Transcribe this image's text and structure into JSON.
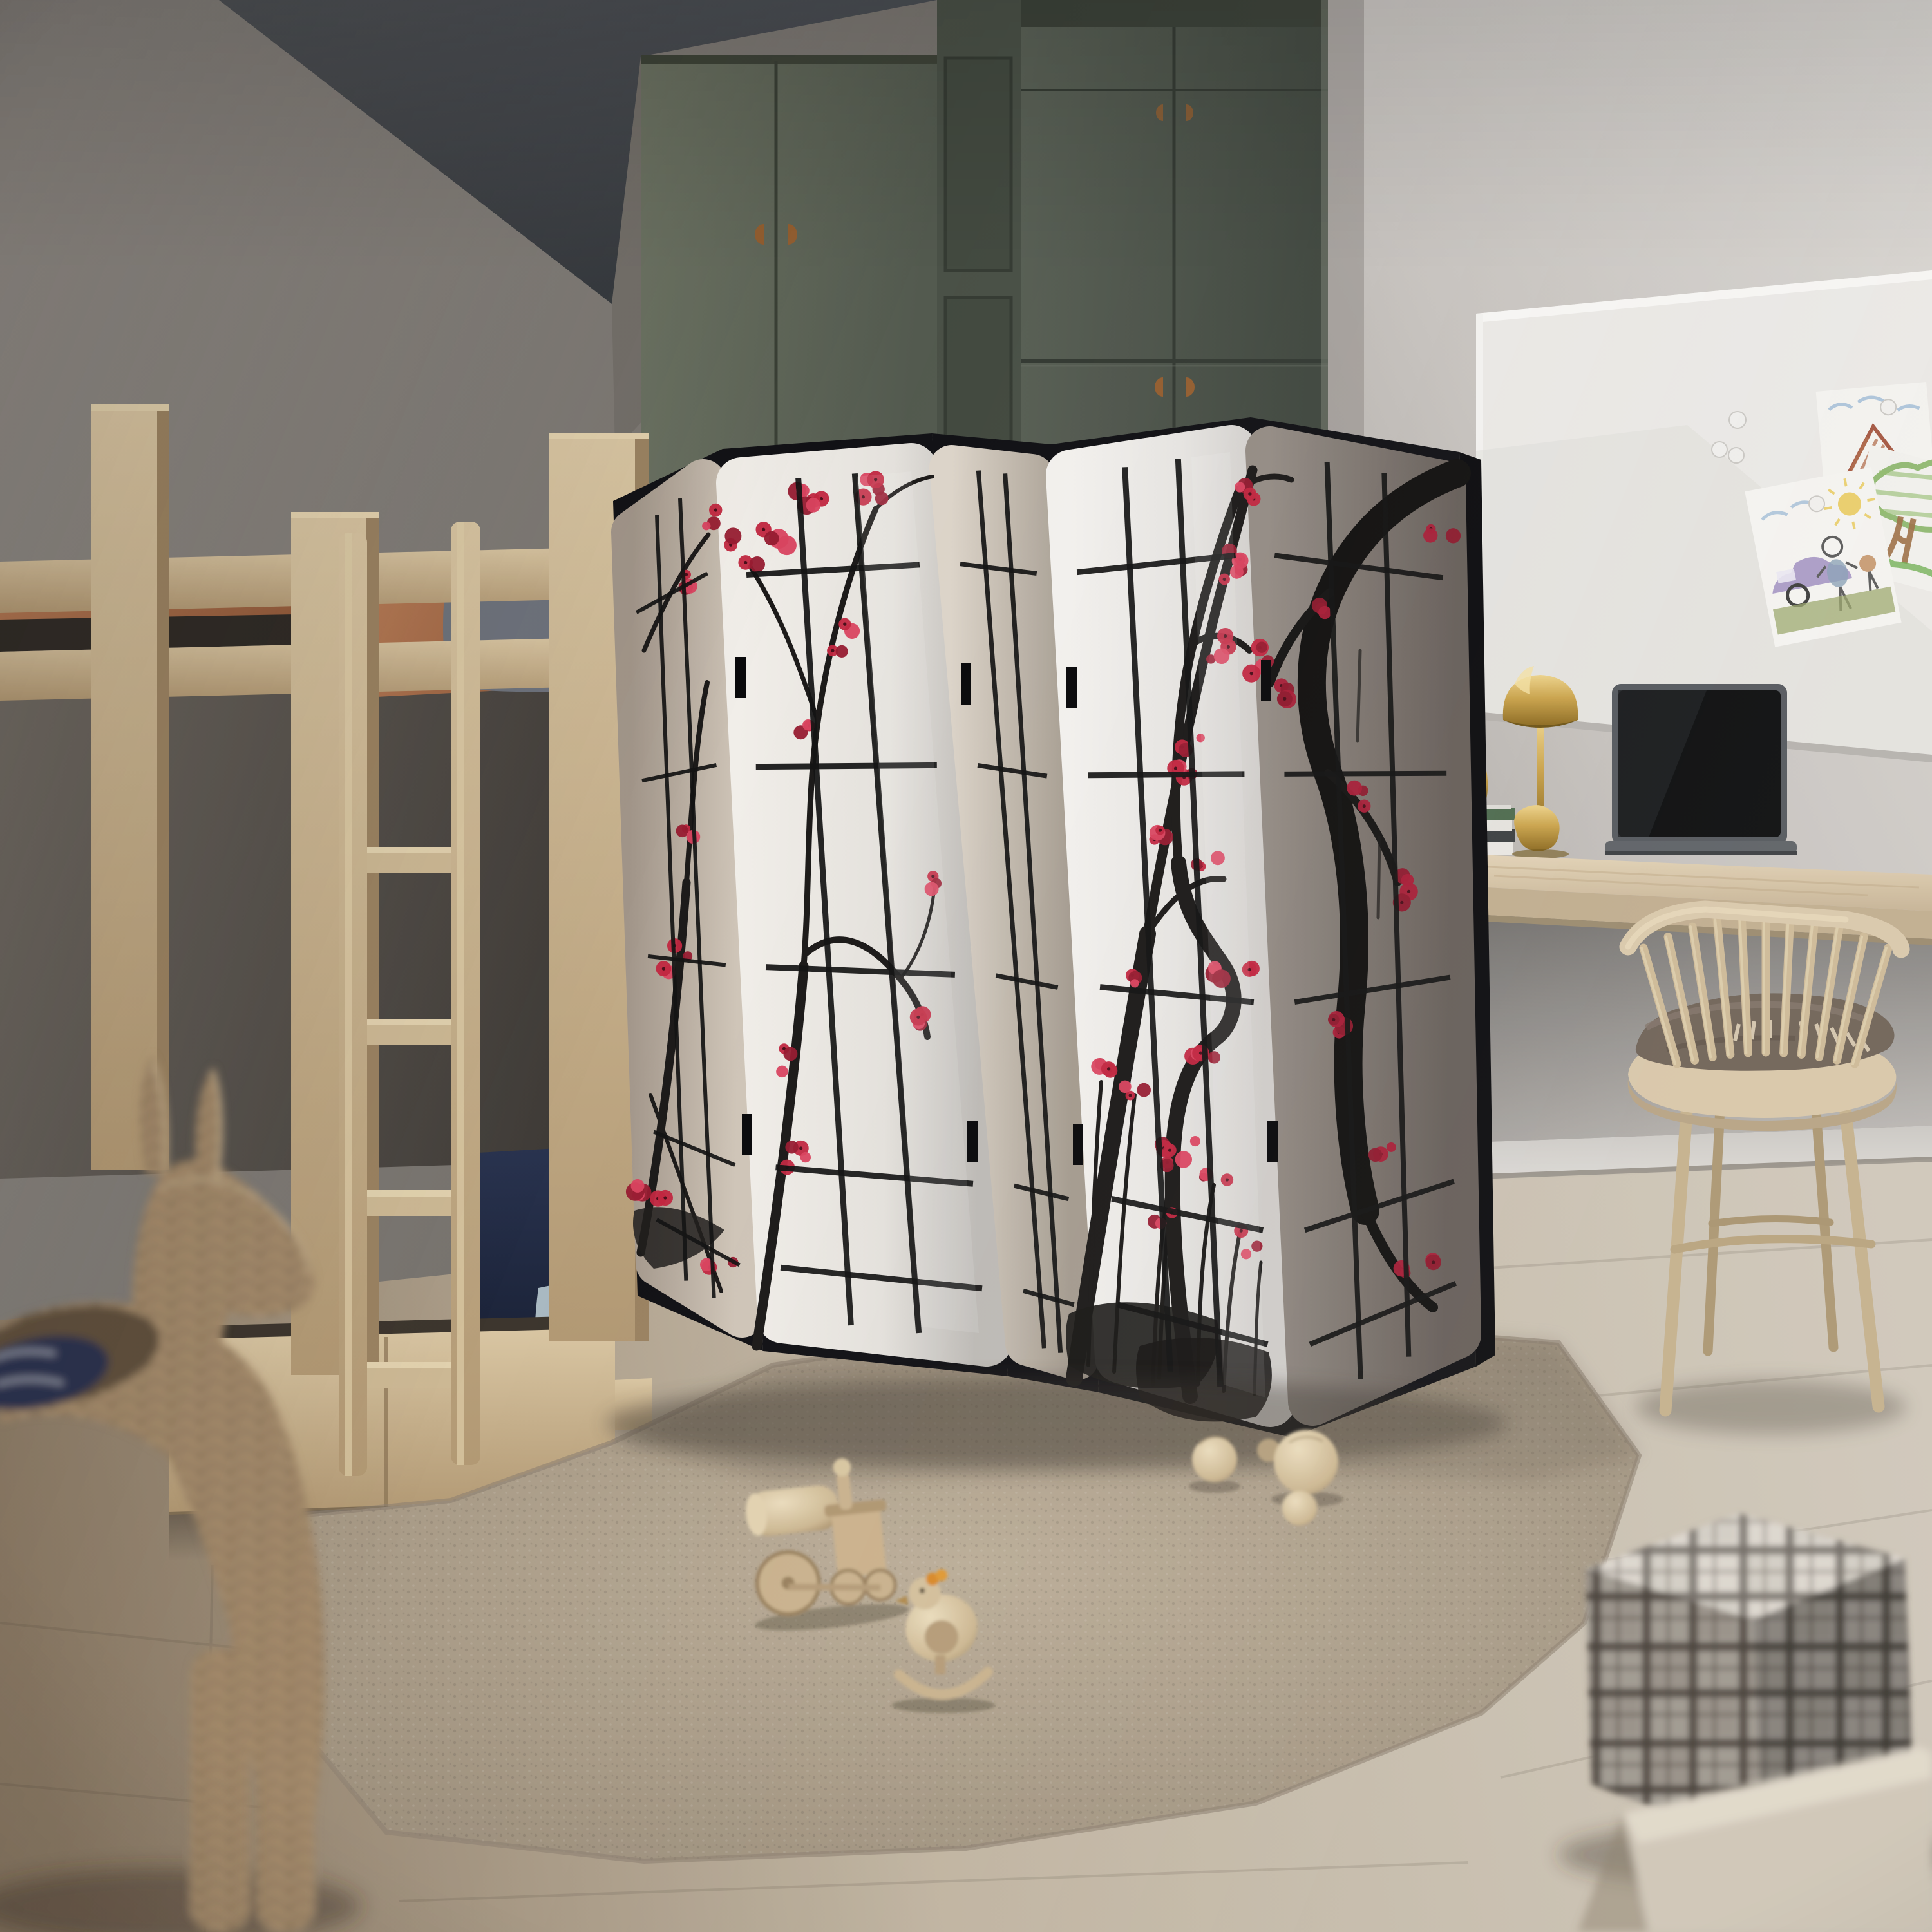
{
  "scene": {
    "description": "Photorealistic render of a children's bedroom with a five-panel black shoji folding screen painted with cherry-plum blossoms, a wooden bunk bed, a sage-green wardrobe, a wall desk with gold lamp and laptop, a spindle chair, a shag rug with wooden toys, a wicker animal basket and plaid storage boxes.",
    "objects": [
      {
        "id": "bunk-bed",
        "label": "wooden bunk bed with ladder"
      },
      {
        "id": "wardrobe",
        "label": "sage green wardrobe"
      },
      {
        "id": "room-divider-screen",
        "label": "5-panel black shoji folding screen with plum blossom ink painting"
      },
      {
        "id": "whiteboard",
        "label": "magnetic whiteboard"
      },
      {
        "id": "drawing-house",
        "label": "child's drawing of a house"
      },
      {
        "id": "drawing-car-figure",
        "label": "child's drawing of car, person and sun"
      },
      {
        "id": "drawing-tree",
        "label": "child's drawing of a tree"
      },
      {
        "id": "magnets",
        "label": "round whiteboard magnets"
      },
      {
        "id": "desk",
        "label": "wall-mounted wooden desk"
      },
      {
        "id": "table-lamp",
        "label": "gold mushroom table lamp"
      },
      {
        "id": "sculpture",
        "label": "small gold sculpture"
      },
      {
        "id": "book-stack",
        "label": "stack of books and magazines"
      },
      {
        "id": "laptop",
        "label": "open laptop with dark screen"
      },
      {
        "id": "chair",
        "label": "light wood spindle chair"
      },
      {
        "id": "throw-blanket",
        "label": "folded taupe blanket with fringe"
      },
      {
        "id": "rug",
        "label": "beige shag rug"
      },
      {
        "id": "wooden-train",
        "label": "wooden toy locomotive"
      },
      {
        "id": "wooden-rocking-bird",
        "label": "wooden rocking bird toy"
      },
      {
        "id": "wooden-balls",
        "label": "four wooden balls"
      },
      {
        "id": "wicker-animal-basket",
        "label": "wicker donkey-shaped basket"
      },
      {
        "id": "plaid-storage-box",
        "label": "plaid fabric storage box"
      },
      {
        "id": "fabric-storage-box",
        "label": "beige fabric storage box"
      }
    ]
  },
  "palette": {
    "ceiling": "#43474d",
    "wall-left": "#8f8b87",
    "wall-left-dark": "#55514c",
    "wall-right": "#dad7d3",
    "wall-right-shade": "#aba7a3",
    "floor-left": "#8c7b66",
    "floor-mid": "#c0b4a1",
    "floor-right": "#cfc7ba",
    "baseboard": "#dcd9d5",
    "wardrobe-far": "#68705f",
    "wardrobe-near": "#515849",
    "wardrobe-dark": "#3c4239",
    "handle-wood": "#945f31",
    "bed-wood": "#cdb893",
    "bed-wood-dark": "#a18868",
    "duvet-top": "#aa684a",
    "pillow-gray": "#6e737d",
    "navy": "#1f2940",
    "pillow-blue": "#a9b9c2",
    "duvet-olive": "#81795e",
    "rug": "#b2a48f",
    "rug-dark": "#968977",
    "screen-frame": "#121216",
    "paper1": "#b4a799",
    "paper2": "#ece9e5",
    "paper3": "#d5cdc2",
    "paper4": "#f0eeeb",
    "paper5": "#8d857f",
    "ink": "#1d1b1a",
    "blossom": "#c12740",
    "blossom-dark": "#971c31",
    "gold": "#c9a24a",
    "gold-dark": "#8a681f",
    "gold-hi": "#ecd28a",
    "laptop-body": "#54585d",
    "laptop-screen": "#0b0c0d",
    "desk-wood": "#d8c7aa",
    "chair-wood": "#d8c7a9",
    "blanket": "#6f6257",
    "fringe": "#d9cbb2",
    "whiteboard": "#eae8e5",
    "magnet": "#f0efed",
    "wicker": "#a98f6f",
    "wicker-dark": "#7a6549",
    "wicker-hi": "#cdb491",
    "plaid-base": "#d5cec4",
    "plaid-dark": "#4f4841",
    "box-lower": "#cfc6b7",
    "crayon-blue": "#9bb8d4",
    "crayon-yellow": "#e8c95c",
    "crayon-green": "#7fae5c",
    "crayon-brown": "#a3704c",
    "crayon-purple": "#9c8cc0",
    "crayon-gray": "#6f6f6f",
    "crayon-grass": "#9aa56b"
  }
}
